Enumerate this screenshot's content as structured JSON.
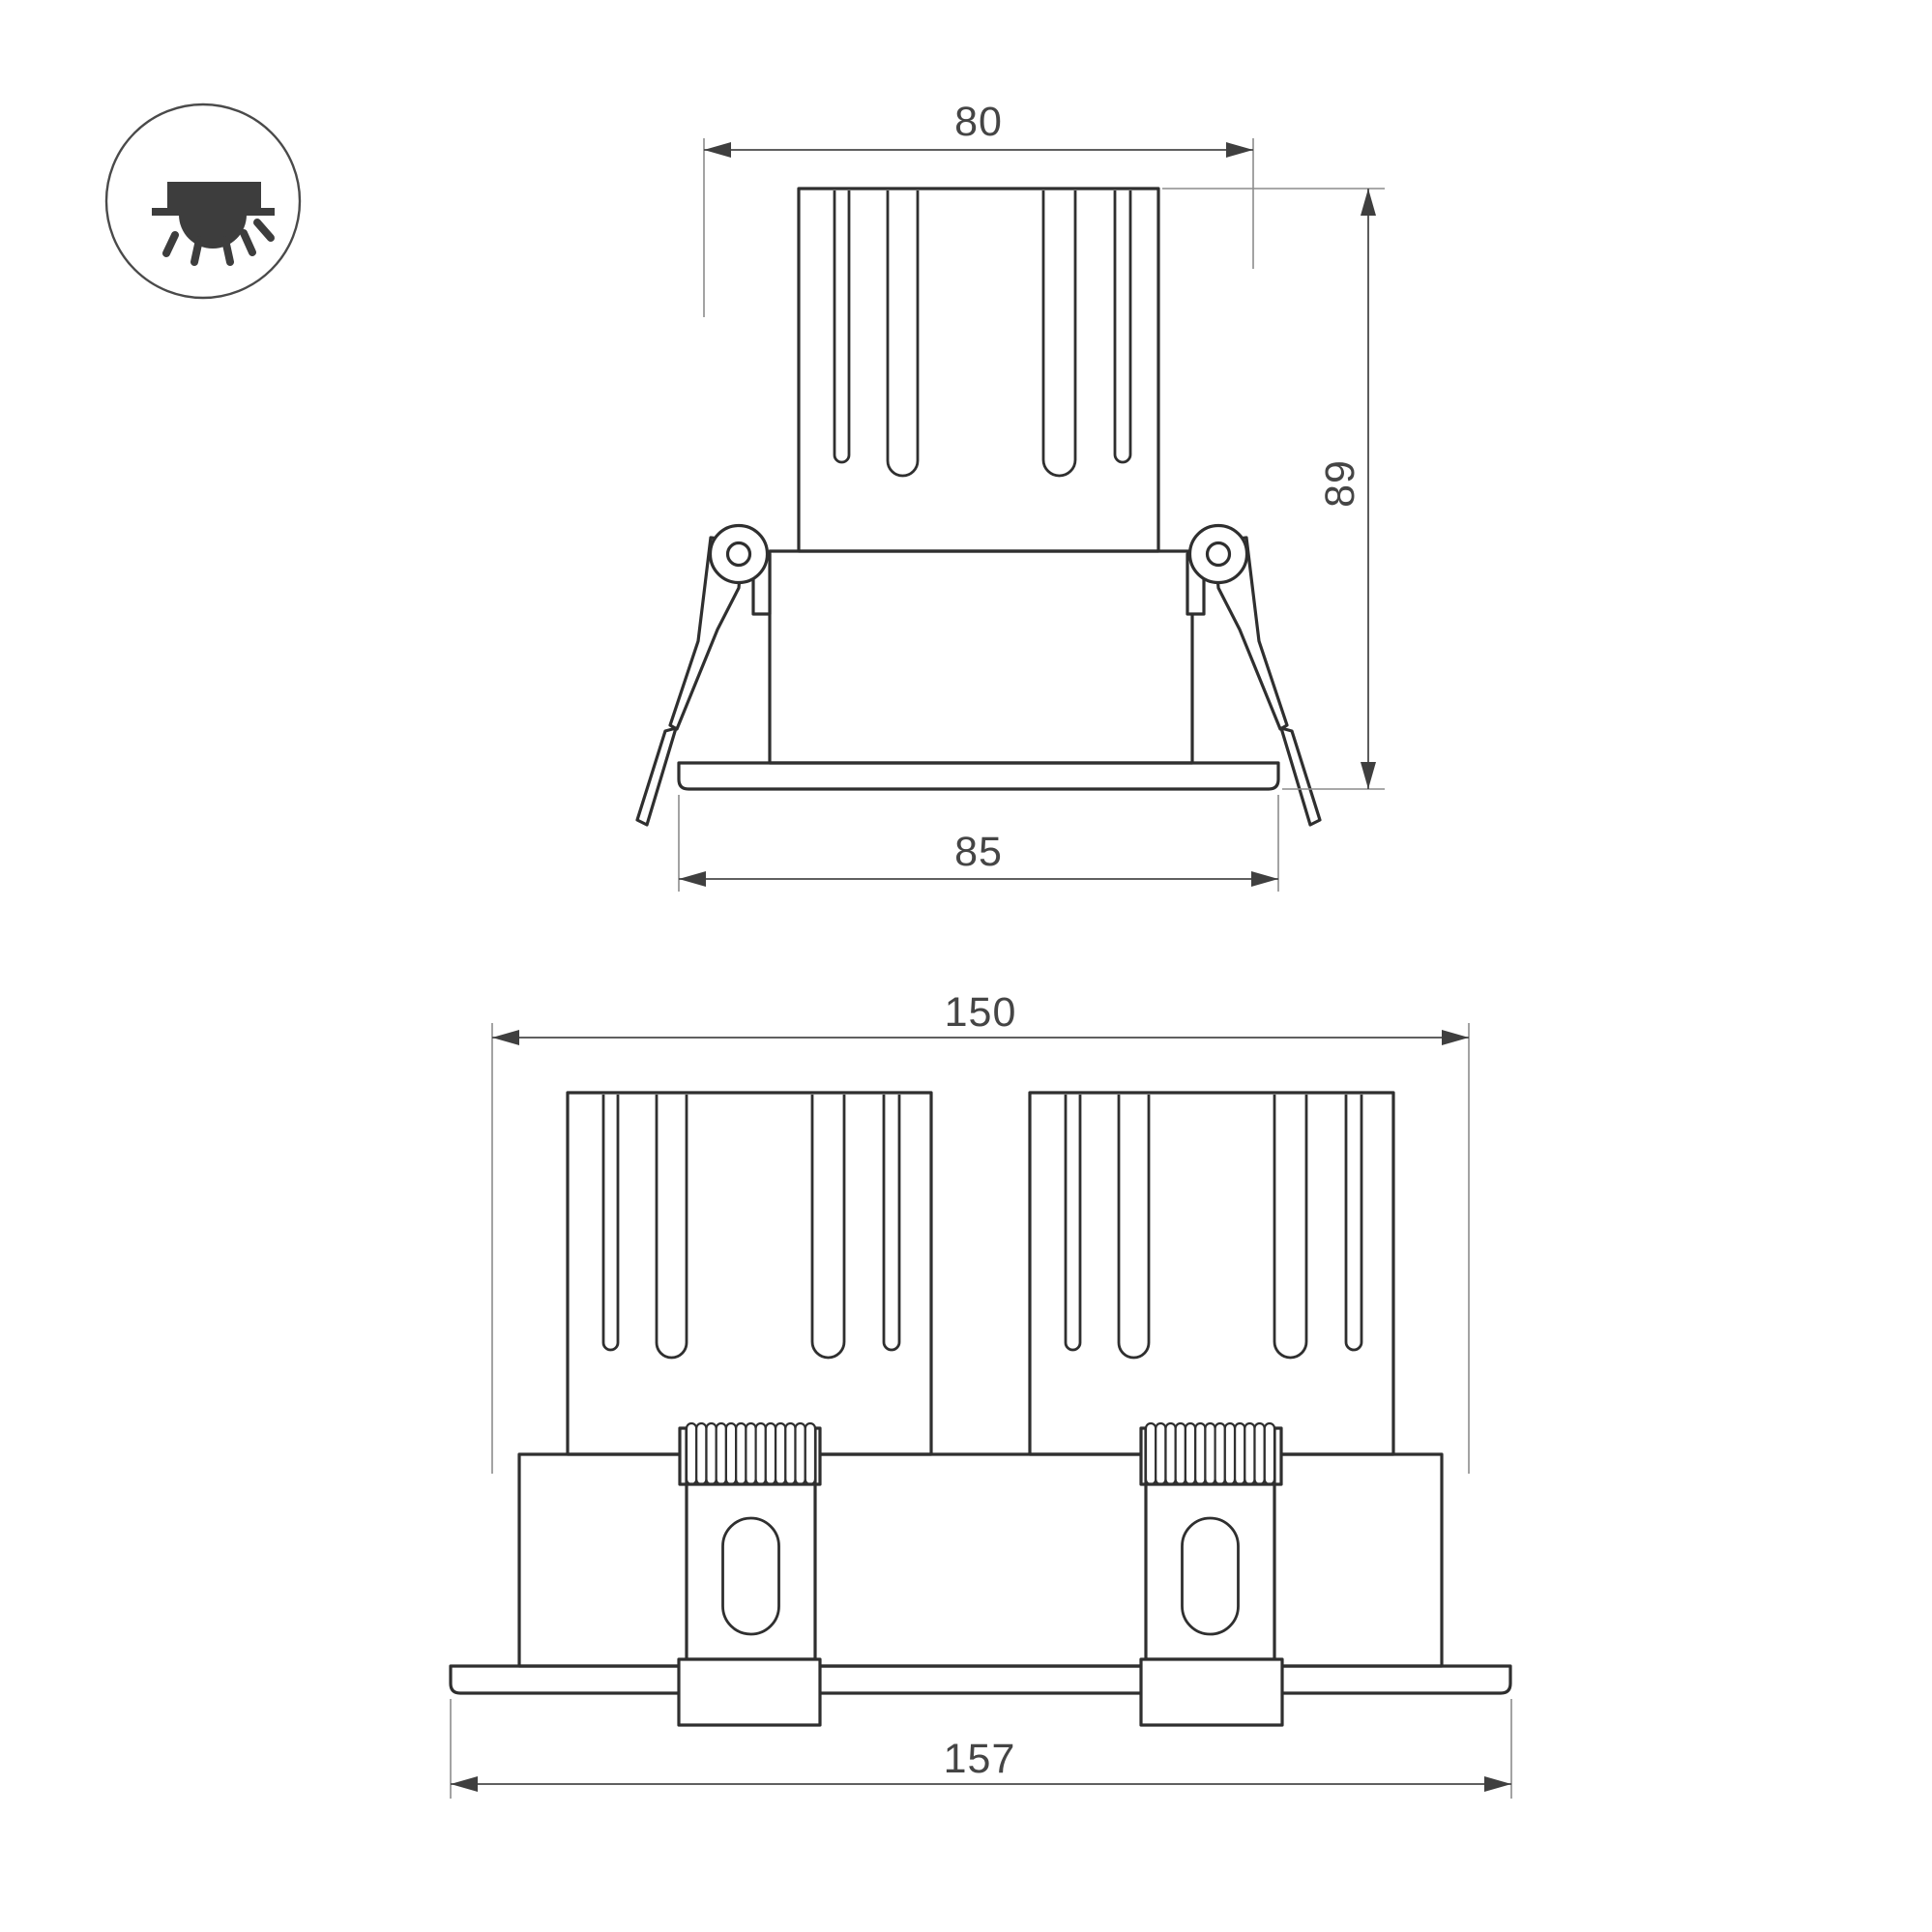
{
  "icon": {
    "name": "recessed-downlight-icon",
    "meaning": "recessed ceiling mount luminaire"
  },
  "colors": {
    "background": "#ffffff",
    "outline": "#2f2f2f",
    "dimension_line": "#4a4a4a",
    "extension_line": "#8c8c8c",
    "label_text": "#454545",
    "icon_glyph": "#3d3d3d"
  },
  "views": {
    "single": {
      "title": "single-spot-front-view",
      "dims": {
        "top_width": "80",
        "height": "89",
        "flange_width": "85"
      }
    },
    "double": {
      "title": "double-spot-front-view",
      "dims": {
        "body_width": "150",
        "flange_width": "157"
      }
    }
  }
}
